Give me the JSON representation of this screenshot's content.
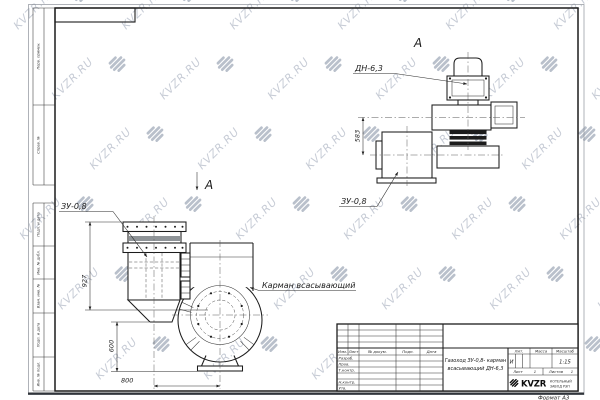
{
  "watermark": {
    "text": "KVZR.RU",
    "text_color": "#c7ccd6",
    "logo_color": "#b9c0cb"
  },
  "sheet": {
    "format_label": "Формат А3"
  },
  "margin_labels": [
    "Перв. примен.",
    "Справ. №",
    "Подп. и дата",
    "Инв. № дубл.",
    "Взам. инв. №",
    "Подп. и дата",
    "Инв. № подл."
  ],
  "title_block": {
    "doc_name_line1": "Газоход ЗУ-0,8- карман",
    "doc_name_line2": "всасывающий ДН-6,3",
    "header_cols": {
      "izm": "Изм.",
      "list": "Лист",
      "doc": "№ докум.",
      "podp": "Подп.",
      "data": "Дата"
    },
    "roles": [
      "Разраб.",
      "Пров.",
      "Т.контр.",
      "Н.контр.",
      "Утв."
    ],
    "lit_label": "Лит.",
    "massa_label": "Масса",
    "masshtab_label": "Масштаб",
    "lit_value": "И",
    "scale_value": "1:15",
    "sheet_label": "Лист",
    "sheet_value": "1",
    "sheets_label": "Листов",
    "sheets_value": "1",
    "company": {
      "logo_text": "KVZR",
      "name_line1": "КОТЕЛЬНЫЙ",
      "name_line2": "ЗАВОД РЭП"
    }
  },
  "views": {
    "front": {
      "view_arrow_label": "А",
      "label_zu": "ЗУ-0,8",
      "label_pocket": "Карман всасывающий",
      "dim_height": "927",
      "dim_lower": "600",
      "dim_width": "800"
    },
    "view_a": {
      "title": "А",
      "label_dn": "ДН-6,3",
      "label_zu": "ЗУ-0,8",
      "dim_height": "583"
    }
  }
}
